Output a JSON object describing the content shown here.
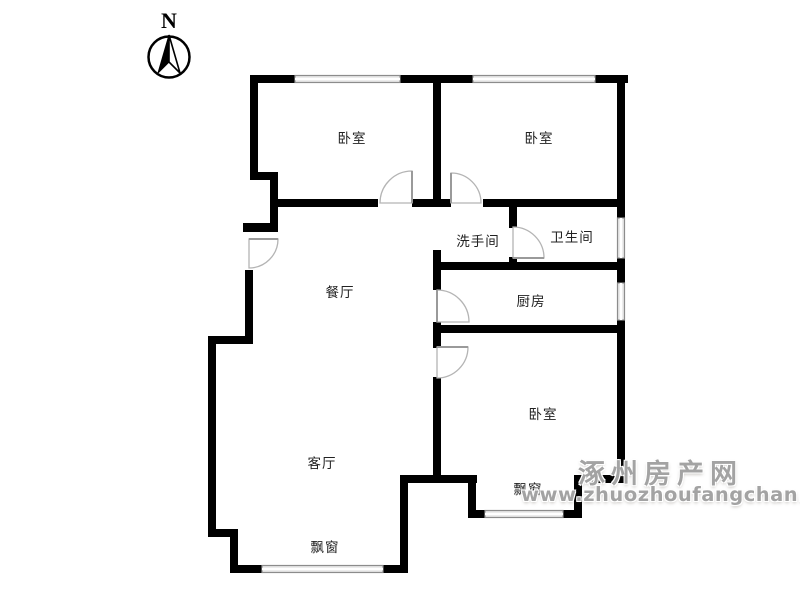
{
  "compass": {
    "label": "N"
  },
  "labels": {
    "bedroom_top_left": "卧室",
    "bedroom_top_right": "卧室",
    "washroom": "洗手间",
    "bathroom": "卫生间",
    "dining": "餐厅",
    "kitchen": "厨房",
    "bedroom_right": "卧室",
    "living": "客厅",
    "bay_window_living": "飘窗",
    "bay_window_bedroom": "飘窗"
  },
  "watermark": {
    "line1": "涿州房产网",
    "line2": "www.zhuozhoufangchan.com"
  },
  "colors": {
    "wall": "#000000",
    "window_line": "#8c8c8c",
    "window_fill": "#e6e6e6",
    "door": "#b4b4b4",
    "label_text": "#222222",
    "watermark": "#a3a3a3",
    "background": "#ffffff"
  }
}
